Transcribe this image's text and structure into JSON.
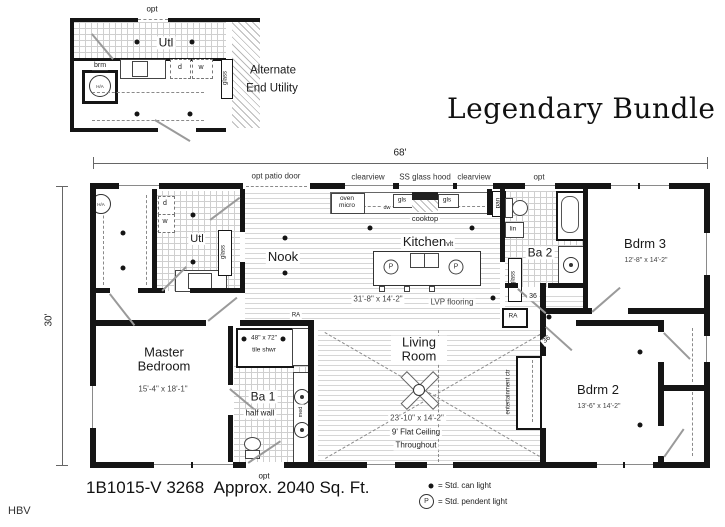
{
  "title": "Legendary Bundle",
  "dims": {
    "width": "68'",
    "depth": "30'"
  },
  "inset": {
    "opt": "opt",
    "utl": "Utl",
    "brm": "brm",
    "ha": "H/A",
    "d": "d",
    "w": "w",
    "glass": "glass",
    "caption1": "Alternate",
    "caption2": "End Utility"
  },
  "plan": {
    "top_labels": {
      "opt_patio_door": "opt patio door",
      "clearview_left": "clearview",
      "ss_glass_hood": "SS glass hood",
      "clearview_right": "clearview",
      "opt": "opt"
    },
    "kitchen": {
      "name": "Kitchen",
      "sub": "vlt",
      "cooktop": "cooktop",
      "oven_micro": "oven micro",
      "dw": "dw",
      "gls_left": "gls",
      "gls_right": "gls",
      "pan": "pan",
      "glass": "glass"
    },
    "utility": {
      "name": "Utl",
      "d": "d",
      "w": "w",
      "glass": "glass",
      "ha": "H/A"
    },
    "nook": {
      "name": "Nook"
    },
    "ba2": {
      "name": "Ba 2",
      "lin": "lin",
      "door36": "36"
    },
    "bdrm3": {
      "name": "Bdrm 3",
      "dim": "12'-8\" x 14'-2\""
    },
    "great_area": {
      "dim": "31'-8\" x 14'-2\"",
      "flooring": "LVP flooring"
    },
    "master": {
      "name": "Master Bedroom",
      "dim": "15'-4\" x 18'-1\""
    },
    "ba1": {
      "name": "Ba 1",
      "shower_size": "48\" x 72\"",
      "shower_type": "tile shwr",
      "half_wall": "half wall",
      "med": "med",
      "opt": "opt"
    },
    "living": {
      "name": "Living Room",
      "dim": "23'-10\" x 14'-2\"",
      "ceiling1": "9' Flat Ceiling",
      "ceiling2": "Throughout",
      "ent_ctr": "entertainment ctr",
      "door36": "36"
    },
    "bdrm2": {
      "name": "Bdrm 2",
      "dim": "13'-6\" x 14'-2\""
    },
    "ra_left": "RA",
    "ra_right": "RA"
  },
  "legend": {
    "can_label": "= Std. can light",
    "pendant_symbol": "P",
    "pendant_label": "= Std. pendent light"
  },
  "footer": {
    "model": "1B1015-V 3268",
    "sqft": "Approx. 2040 Sq. Ft.",
    "code": "HBV"
  }
}
